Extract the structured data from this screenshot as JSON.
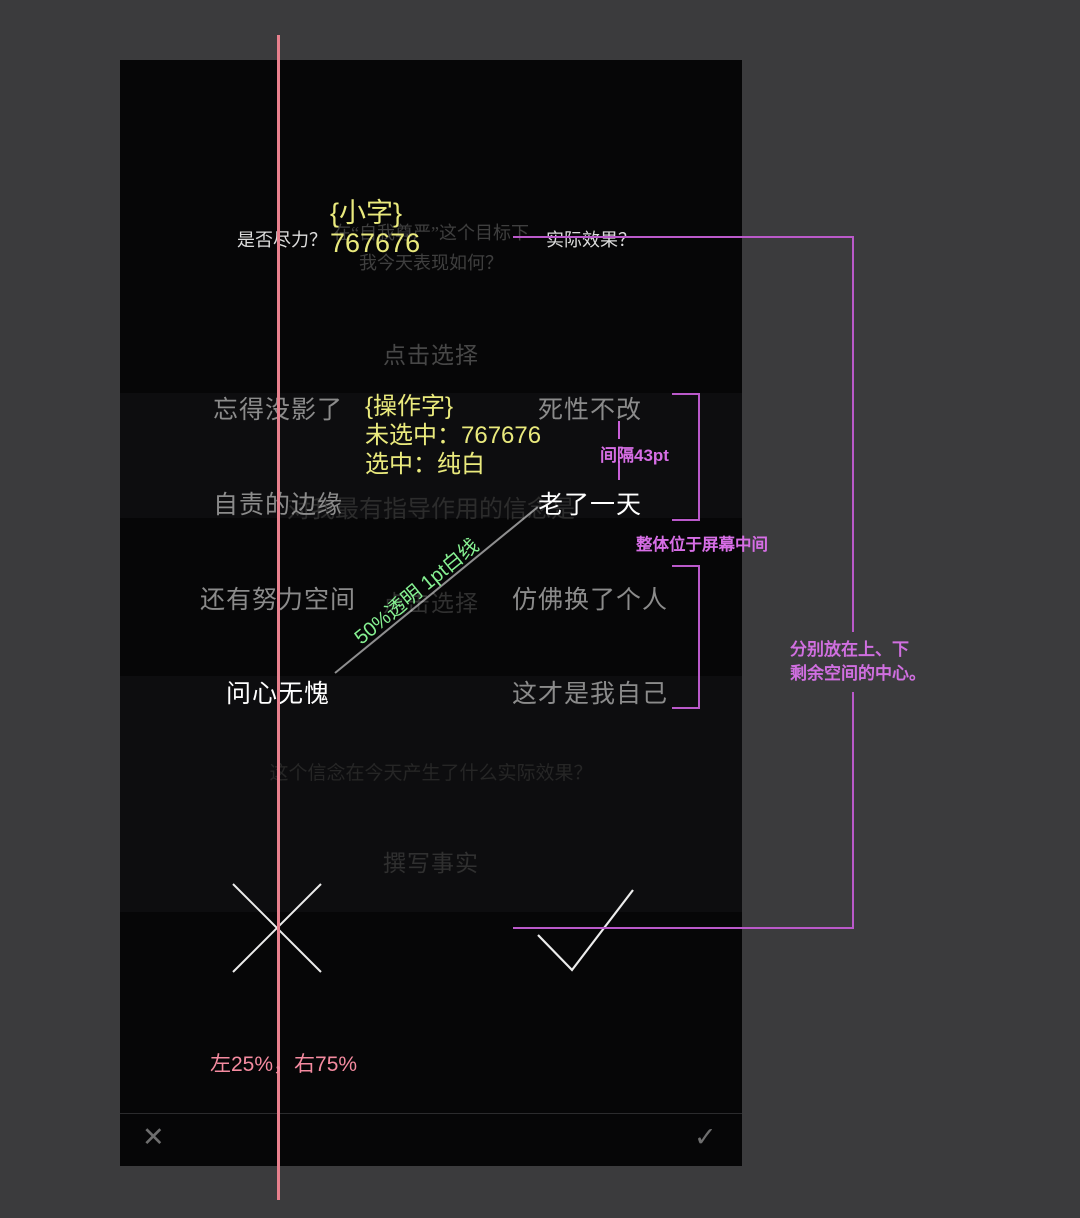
{
  "colors": {
    "outer_bg": "#3b3b3d",
    "phone_bg": "#060607",
    "selected_text": "#ffffff",
    "unselected_text": "#8b8b8b",
    "annotation_yellow": "#eaea7d",
    "annotation_magenta": "#c95fd8",
    "annotation_green": "#86f192",
    "annotation_pink": "#ee8094"
  },
  "phone": {
    "top_question": {
      "line1": "在“自我尊严”这个目标下",
      "line2": "我今天表现如何？"
    },
    "top_left_label": "是否尽力？",
    "top_right_label": "实际效果？",
    "select_prompt_1": "点击选择",
    "select_prompt_2": "点击选择",
    "belief_question": "对我最有指导作用的信念是",
    "options": {
      "left": [
        "忘得没影了",
        "自责的边缘",
        "还有努力空间",
        "问心无愧"
      ],
      "right": [
        "死性不改",
        "老了一天",
        "仿佛换了个人",
        "这才是我自己"
      ],
      "selected": [
        "老了一天",
        "问心无愧"
      ]
    },
    "effect_question": "这个信念在今天产生了什么实际效果？",
    "write_facts_prompt": "撰写事实",
    "bottom_bar": {
      "cancel_icon": "✕",
      "confirm_icon": "✓"
    }
  },
  "annotations": {
    "small_text": {
      "title": "{小字}",
      "value": "767676"
    },
    "action_text": {
      "title": "{操作字}",
      "unselected": "未选中：767676",
      "selected": "选中：纯白"
    },
    "gap_label": "间隔43pt",
    "center_label": "整体位于屏幕中间",
    "diagonal_label": "50%透明  1pt白线",
    "split_label": "左25%，右75%",
    "spacing_note": {
      "line1": "分别放在上、下",
      "line2": "剩余空间的中心。"
    }
  }
}
